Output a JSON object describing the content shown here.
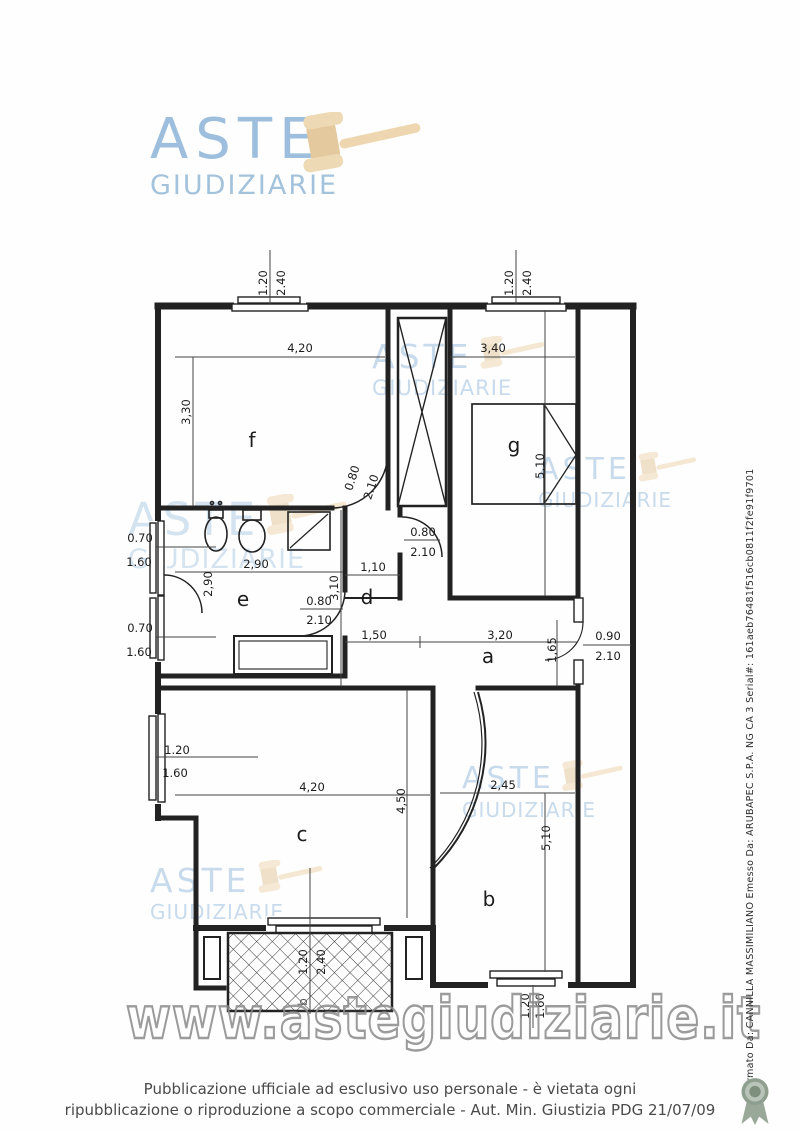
{
  "brand": {
    "name_top": "ASTE",
    "name_bottom": "GIUDIZIARIE"
  },
  "watermark": {
    "word_top": "ASTE",
    "word_bottom": "GIUDIZIARIE",
    "url": "www.astegiudiziarie.it"
  },
  "colors": {
    "logo_blue": "#9dbfdd",
    "watermark_blue": "#9abede",
    "gavel_beige": "#e4c89e",
    "ink": "#1c1c1c",
    "url_outline_gray": "#8a8a8a",
    "footer_gray": "#4a4a4a",
    "seal_green": "#8f9f8f"
  },
  "plan": {
    "room_labels": {
      "a": "a",
      "b": "b",
      "c": "c",
      "d": "d",
      "e": "e",
      "f": "f",
      "g": "g"
    },
    "balcony_mark": "b",
    "dims": {
      "top_window_left_w": "1.20",
      "top_window_left_h": "2.40",
      "top_window_right_w": "1.20",
      "top_window_right_h": "2.40",
      "room_f_w": "4,20",
      "room_f_h": "3,30",
      "room_g_w": "3,40",
      "room_g_h": "5,10",
      "bath_window_upper_w": "0.70",
      "bath_window_upper_h": "1.60",
      "bath_window_lower_w": "0.70",
      "bath_window_lower_h": "1.60",
      "room_e_w": "2,90",
      "room_e_h": "2,90",
      "room_d_w": "1,10",
      "room_d_h": "3,10",
      "door_f_w": "0.80",
      "door_f_h": "2.10",
      "door_d_w": "0.80",
      "door_d_h": "2.10",
      "door_e_w": "0.80",
      "door_e_h": "2.10",
      "hall_seg_left": "1,50",
      "hall_seg_right": "3,20",
      "hall_depth": "1,65",
      "entry_door_w": "0.90",
      "entry_door_h": "2.10",
      "room_c_window_w": "1.20",
      "room_c_window_h": "1.60",
      "room_c_w": "4,20",
      "room_c_h": "4,50",
      "room_b_w": "2,45",
      "room_b_h": "5,10",
      "balcony_door_w": "1.20",
      "balcony_door_h": "2.40",
      "room_b_window_w": "1.20",
      "room_b_window_h": "1.60"
    }
  },
  "footer": {
    "line1": "Pubblicazione ufficiale ad esclusivo uso personale - è vietata ogni",
    "line2": "ripubblicazione o riproduzione a scopo commerciale - Aut. Min. Giustizia PDG 21/07/09"
  },
  "signature": {
    "text": "Firmato Da: CANNILLA MASSIMILIANO Emesso Da: ARUBAPEC S.P.A. NG CA 3 Serial#: 161aeb76481f516cb0811f2fe91f9701"
  }
}
